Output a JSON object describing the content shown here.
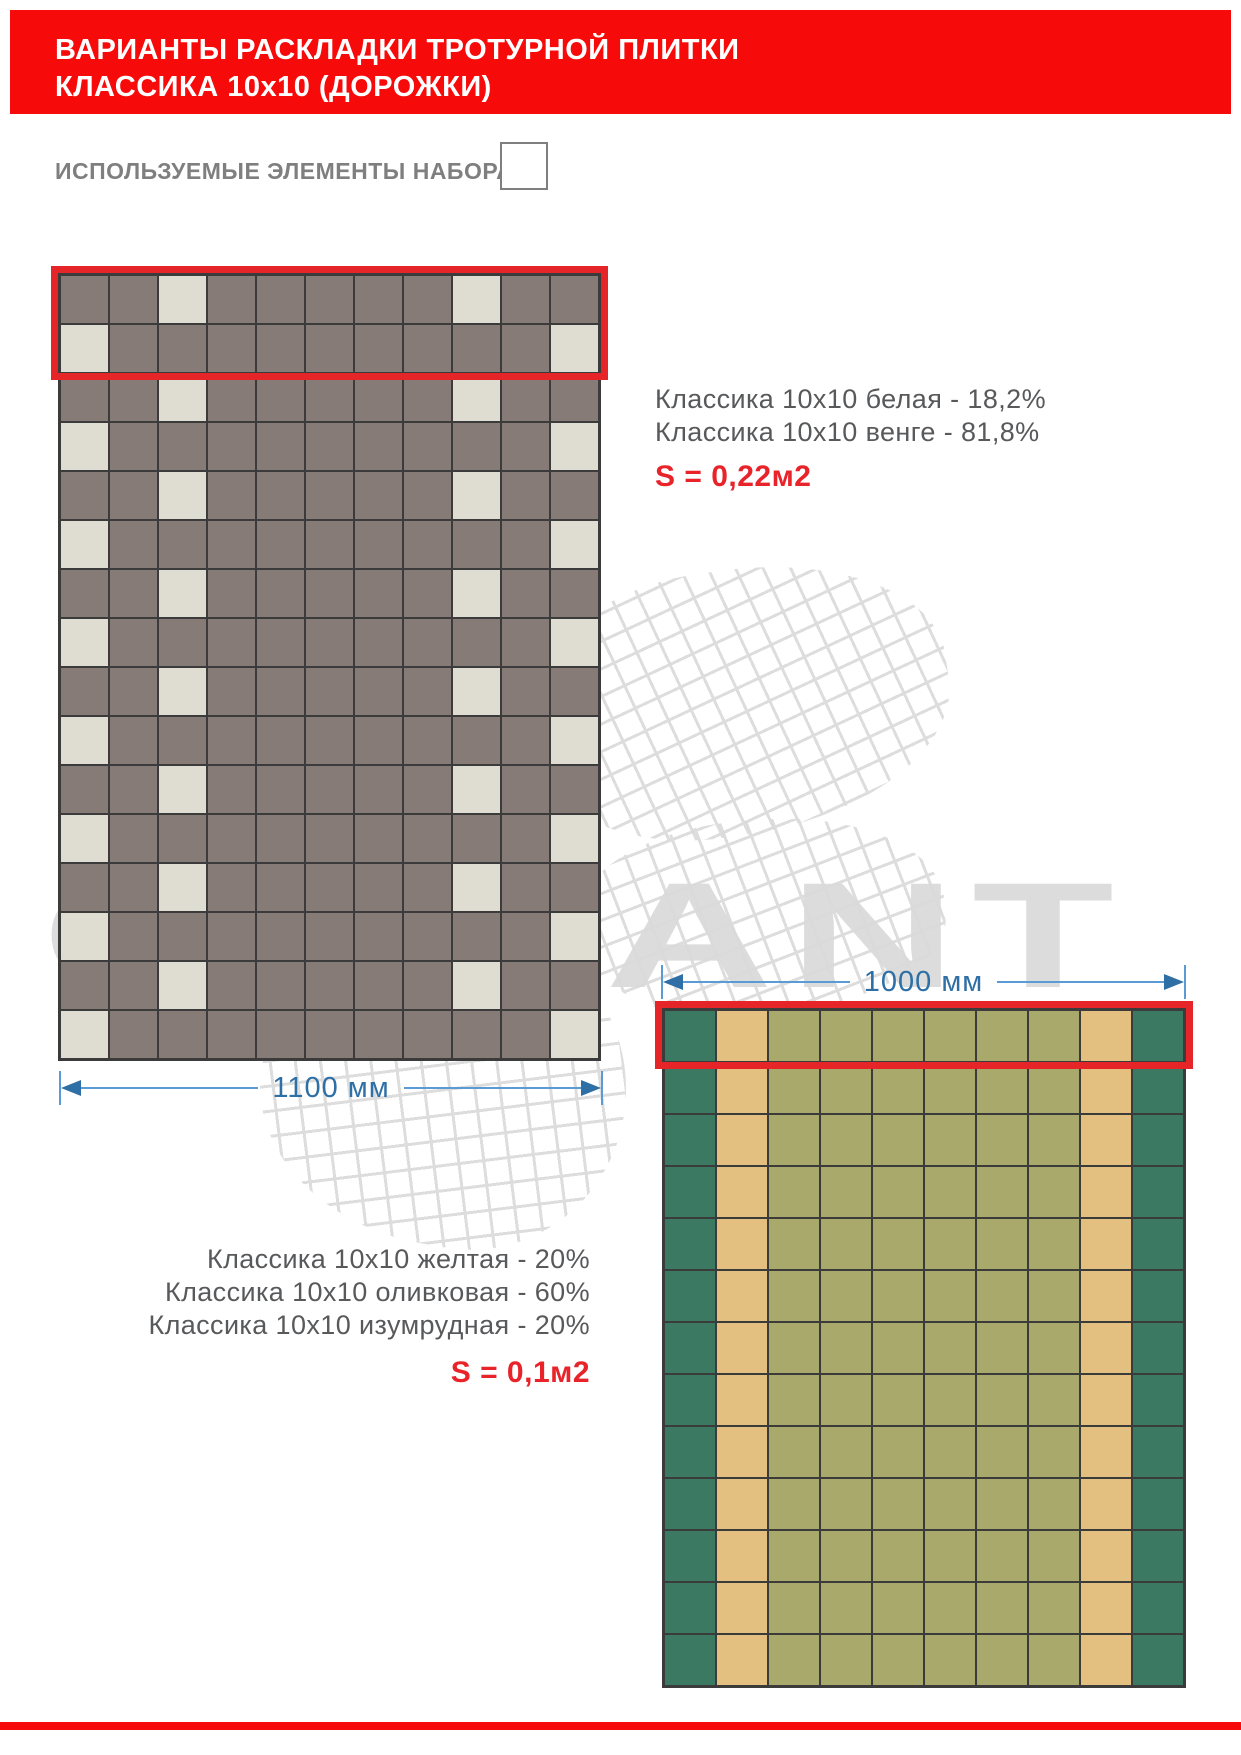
{
  "header": {
    "line1": "ВАРИАНТЫ РАСКЛАДКИ ТРОТУРНОЙ ПЛИТКИ",
    "line2": "КЛАССИКА 10х10 (ДОРОЖКИ)"
  },
  "elements_label": "ИСПОЛЬЗУЕМЫЕ ЭЛЕМЕНТЫ НАБОРА",
  "watermark": {
    "text": "GARANT",
    "color": "#DCDCDC"
  },
  "colors": {
    "bar_red": "#F70A0A",
    "highlight_red": "#E52528",
    "area_text_red": "#E8242A",
    "dimension_blue": "#2E6FA5",
    "dimension_line_blue": "#5B9BD5",
    "legend_gray": "#58595B",
    "label_gray": "#7F7F7F",
    "grid_line": "#3B3B3B"
  },
  "layout1": {
    "legend_lines": [
      "Классика 10х10 белая - 18,2%",
      "Классика 10х10 венге - 81,8%"
    ],
    "area_label": "S = 0,22м2",
    "dimension_label": "1100 мм",
    "grid": {
      "cols": 11,
      "rows": 16,
      "highlight_rows": 2,
      "palette": {
        "B": {
          "name": "венге",
          "color": "#877B77"
        },
        "W": {
          "name": "белая",
          "color": "#DFDDD2"
        }
      },
      "rows_pattern": [
        "BBWBBBBBWBB",
        "WBBBBBBBBBW",
        "BBWBBBBBWBB",
        "WBBBBBBBBBW",
        "BBWBBBBBWBB",
        "WBBBBBBBBBW",
        "BBWBBBBBWBB",
        "WBBBBBBBBBW",
        "BBWBBBBBWBB",
        "WBBBBBBBBBW",
        "BBWBBBBBWBB",
        "WBBBBBBBBBW",
        "BBWBBBBBWBB",
        "WBBBBBBBBBW",
        "BBWBBBBBWBB",
        "WBBBBBBBBBW"
      ]
    }
  },
  "layout2": {
    "legend_lines": [
      "Классика 10х10 желтая - 20%",
      "Классика 10х10 оливковая - 60%",
      "Классика 10х10 изумрудная - 20%"
    ],
    "area_label": "S = 0,1м2",
    "dimension_label": "1000 мм",
    "grid": {
      "cols": 10,
      "rows": 13,
      "highlight_rows": 1,
      "palette": {
        "E": {
          "name": "изумрудная",
          "color": "#3C7963"
        },
        "Y": {
          "name": "желтая",
          "color": "#E3C07F"
        },
        "O": {
          "name": "оливковая",
          "color": "#A9A96C"
        }
      },
      "rows_pattern": [
        "EYOOOOOOYE",
        "EYOOOOOOYE",
        "EYOOOOOOYE",
        "EYOOOOOOYE",
        "EYOOOOOOYE",
        "EYOOOOOOYE",
        "EYOOOOOOYE",
        "EYOOOOOOYE",
        "EYOOOOOOYE",
        "EYOOOOOOYE",
        "EYOOOOOOYE",
        "EYOOOOOOYE",
        "EYOOOOOOYE"
      ]
    }
  }
}
